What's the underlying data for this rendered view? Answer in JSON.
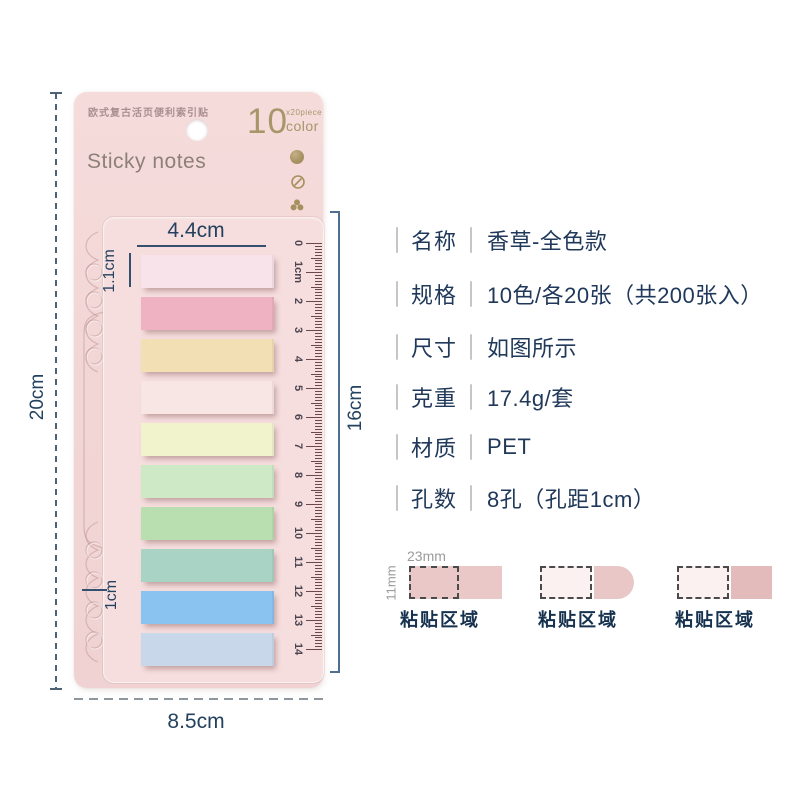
{
  "card": {
    "subtitle": "欧式复古活页便利索引贴",
    "title": "Sticky notes",
    "badge": {
      "number": "10",
      "sub_top": "x20piece",
      "sub_bottom": "color"
    },
    "strip_colors": [
      "#f7e3e9",
      "#efb2c2",
      "#f2dfb3",
      "#f8e6e4",
      "#f1f3cd",
      "#cde9c6",
      "#b9dfb1",
      "#a9d3c4",
      "#8ac3ef",
      "#c8d7ea"
    ],
    "ruler_labels": [
      "0",
      "1cm",
      "2",
      "3",
      "4",
      "5",
      "6",
      "7",
      "8",
      "9",
      "10",
      "11",
      "12",
      "13",
      "14"
    ],
    "icons": [
      "gold-dot-icon",
      "gold-slash-circle-icon",
      "gold-trefoil-icon"
    ]
  },
  "dimensions": {
    "strip_width": "4.4cm",
    "strip_height": "1.1cm",
    "card_height": "20cm",
    "card_width": "8.5cm",
    "ruler_span": "16cm",
    "hole_spacing": "1cm"
  },
  "specs": [
    {
      "label": "名称",
      "value": "香草-全色款"
    },
    {
      "label": "规格",
      "value": "10色/各20张（共200张入）"
    },
    {
      "label": "尺寸",
      "value": "如图所示"
    },
    {
      "label": "克重",
      "value": "17.4g/套"
    },
    {
      "label": "材质",
      "value": "PET"
    },
    {
      "label": "孔数",
      "value": "8孔（孔距1cm）"
    }
  ],
  "adhesive_diagrams": {
    "width_label": "23mm",
    "height_label": "11mm",
    "items": [
      {
        "label": "粘贴区域",
        "style": "full-pink-with-dashed-zone"
      },
      {
        "label": "粘贴区域",
        "style": "dashed-zone-plus-rounded-tab"
      },
      {
        "label": "粘贴区域",
        "style": "dashed-zone-plus-square-tab"
      }
    ]
  },
  "palette": {
    "card_bg": "#f3d8d8",
    "panel_bg": "#f6dede",
    "text_navy": "#20395a",
    "gold": "#a8956a",
    "gray": "#9b9b9b",
    "ruler_tick": "#6d4848",
    "diagram_pink": "#ebc8c8",
    "diagram_pale": "#fbf1f1"
  }
}
